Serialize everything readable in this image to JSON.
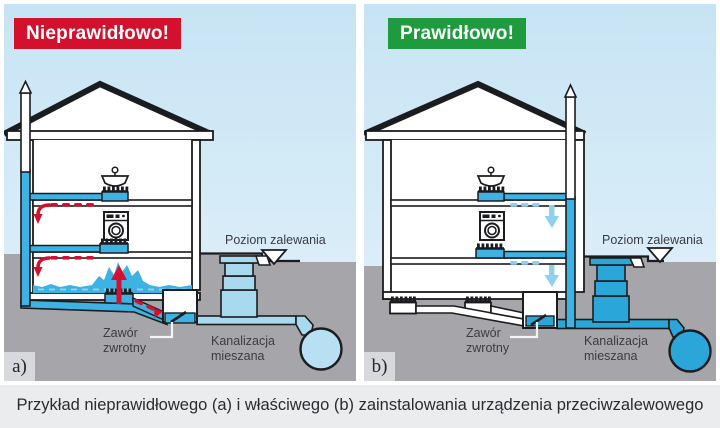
{
  "figure": {
    "caption": "Przykład nieprawidłowego (a) i właściwego (b) zainstalowania urządzenia przeciwzalewowego"
  },
  "colors": {
    "incorrect_banner_red": "#d3112e",
    "correct_banner_green": "#1e9b3e",
    "water_blue": "#3eb2e2",
    "sewer_solid_blue": "#2aa7d8",
    "light_pipe_blue": "#a9d9ef",
    "flow_arrow_light_blue": "#8fd0ec",
    "backflow_red": "#d3112e",
    "ground_gray": "#a6a6aa",
    "sky_blue": "#c7e4f4",
    "outline_dark": "#1b1c1f"
  },
  "panels": [
    {
      "corner_label": "a)",
      "banner": {
        "text": "Nieprawidłowo!",
        "color": "#d3112e"
      },
      "labels": {
        "flood_level": "Poziom zalewania",
        "check_valve_line1": "Zawór",
        "check_valve_line2": "zwrotny",
        "sewer_line1": "Kanalizacja",
        "sewer_line2": "mieszana"
      }
    },
    {
      "corner_label": "b)",
      "banner": {
        "text": "Prawidłowo!",
        "color": "#1e9b3e"
      },
      "labels": {
        "flood_level": "Poziom zalewania",
        "check_valve_line1": "Zawór",
        "check_valve_line2": "zwrotny",
        "sewer_line1": "Kanalizacja",
        "sewer_line2": "mieszana"
      }
    }
  ]
}
